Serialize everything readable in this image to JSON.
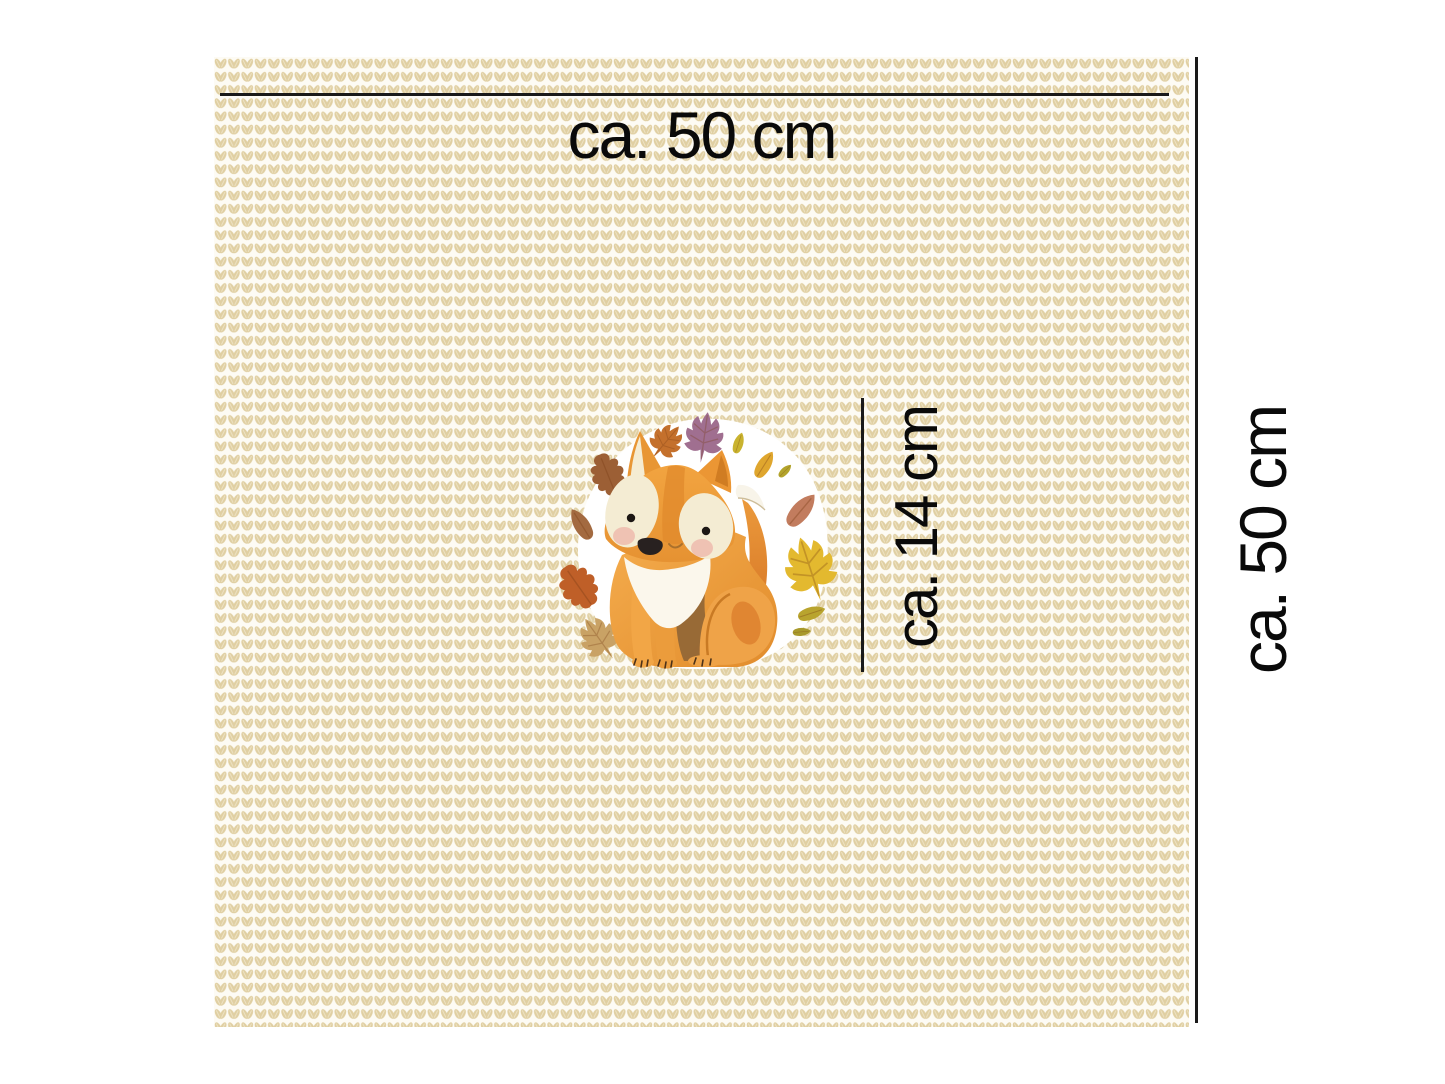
{
  "panel": {
    "width_label": "ca. 50 cm",
    "height_label": "ca. 50 cm",
    "motif_height_label": "ca. 14 cm"
  },
  "fabric": {
    "texture": "knit-stitch-pattern",
    "stitch_color": "#e0cfa2",
    "stitch_highlight": "#efe5c8",
    "base_color": "#fdfbf4"
  },
  "measurement": {
    "line_color": "#1a1a1a",
    "text_color": "#0a0a0a"
  },
  "illustration": {
    "subject": "watercolor fox with autumn leaves wreath",
    "backdrop_color": "#ffffff",
    "fox_orange": "#efa041",
    "fox_orange_dark": "#d06a1e",
    "fox_cream": "#f4ecd3",
    "blush_pink": "#eec0b1",
    "nose_color": "#282120",
    "leaf_colors": [
      "#c4702c",
      "#a06f90",
      "#c9b32f",
      "#dfa62e",
      "#c27c5e",
      "#e3b92f",
      "#9c5f35",
      "#bf5f28",
      "#c9a265",
      "#b3a42c"
    ]
  }
}
